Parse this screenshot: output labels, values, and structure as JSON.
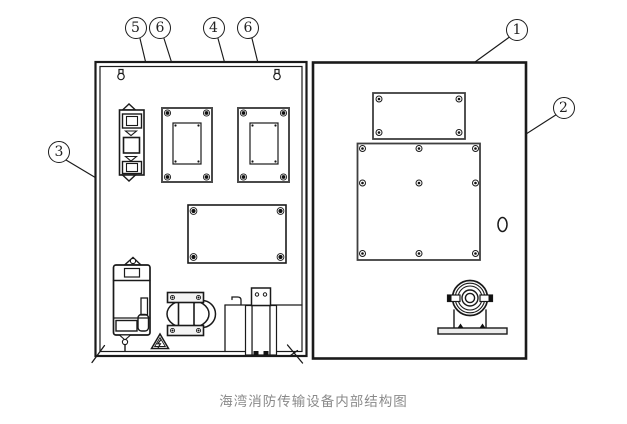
{
  "figure": {
    "caption": "海湾消防传输设备内部结构图",
    "type": "technical-line-diagram"
  },
  "callouts": {
    "c5": {
      "label": "5"
    },
    "c6a": {
      "label": "6"
    },
    "c4": {
      "label": "4"
    },
    "c6b": {
      "label": "6"
    },
    "c1": {
      "label": "1"
    },
    "c2": {
      "label": "2"
    },
    "c3": {
      "label": "3"
    }
  },
  "components": {
    "left_panel": [
      "mounting-keyhole-left",
      "mounting-keyhole-right",
      "fuse-terminal-block",
      "module-plate-left",
      "module-plate-right",
      "center-module-board",
      "power-supply-unit",
      "high-voltage-warning-triangle",
      "transformer",
      "cable-bracket",
      "corner-shelf",
      "corner-break-marks"
    ],
    "right_panel": [
      "top-module-board",
      "main-module-board",
      "cable-hole",
      "alarm-gong"
    ]
  },
  "colors": {
    "line": "#1a1a1a",
    "plate_stroke": "#4a4a4a",
    "caption_text": "#8a8a8a",
    "background": "#ffffff"
  }
}
